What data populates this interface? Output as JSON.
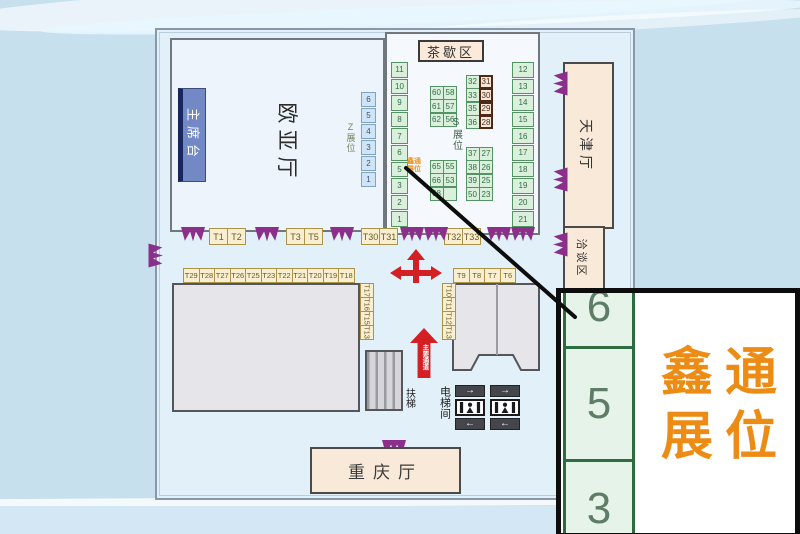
{
  "halls": {
    "stage": "主席台",
    "euroasia": "欧亚厅",
    "tea_break": "茶歇区",
    "tianjin": "天津厅",
    "negotiation": "洽谈区",
    "chongqing": "重庆厅"
  },
  "zones": {
    "z_zone": "Z展位",
    "s_zone": "S展位",
    "escalator": "扶梯",
    "elevator_room": "电梯间",
    "main_aisle": "主要通道",
    "xintong_mini_line1": "鑫通",
    "xintong_mini_line2": "展位"
  },
  "booths": {
    "z_col": [
      "6",
      "5",
      "4",
      "3",
      "2",
      "1"
    ],
    "s_left_col": [
      "11",
      "10",
      "9",
      "8",
      "7",
      "6",
      "5",
      "3",
      "2",
      "1"
    ],
    "s_right_col": [
      "12",
      "13",
      "14",
      "15",
      "16",
      "17",
      "18",
      "19",
      "20",
      "21"
    ],
    "s_block_nw": [
      [
        "60",
        "58"
      ],
      [
        "61",
        "57"
      ],
      [
        "62",
        "56"
      ]
    ],
    "s_block_sw": [
      [
        "65",
        "55"
      ],
      [
        "66",
        "53"
      ],
      [
        "68",
        ""
      ]
    ],
    "s_block_ne": [
      [
        "32",
        "31"
      ],
      [
        "33",
        "30"
      ],
      [
        "35",
        "29"
      ],
      [
        "36",
        "28"
      ]
    ],
    "s_block_se": [
      [
        "37",
        "27"
      ],
      [
        "38",
        "26"
      ],
      [
        "39",
        "25"
      ],
      [
        "50",
        "23"
      ]
    ],
    "t_top_g1": [
      "T1",
      "T2"
    ],
    "t_top_g2": [
      "T3",
      "T5"
    ],
    "t_top_g3": [
      "T30",
      "T31"
    ],
    "t_top_g4": [
      "T32",
      "T33"
    ],
    "t_row_left": [
      "T29",
      "T28",
      "T27",
      "T26",
      "T25",
      "T23",
      "T22",
      "T21",
      "T20",
      "T19",
      "T18"
    ],
    "t_col_left_hall": [
      "T17",
      "T16",
      "T15",
      "T13"
    ],
    "t_row_right": [
      "T9",
      "T8",
      "T7",
      "T6"
    ],
    "t_col_right_hall": [
      "T10",
      "T11",
      "T12",
      "T13"
    ]
  },
  "elevator": {
    "arrow_right": "→",
    "arrow_left": "←"
  },
  "callout": {
    "cells": [
      "6",
      "5",
      "3"
    ],
    "highlighted_booth": "5",
    "brand_line1": "鑫通",
    "brand_line2": "展位"
  },
  "colors": {
    "booth_green_fill": "#daefdc",
    "booth_green_border": "#559264",
    "highlight_booth_border": "#4e2a16",
    "brand_orange": "#ec8c15",
    "arrow_red": "#d32024",
    "swag_purple": "#8b2f8b",
    "stage_blue": "#7289c6",
    "hall_beige": "#f9e9d8"
  }
}
